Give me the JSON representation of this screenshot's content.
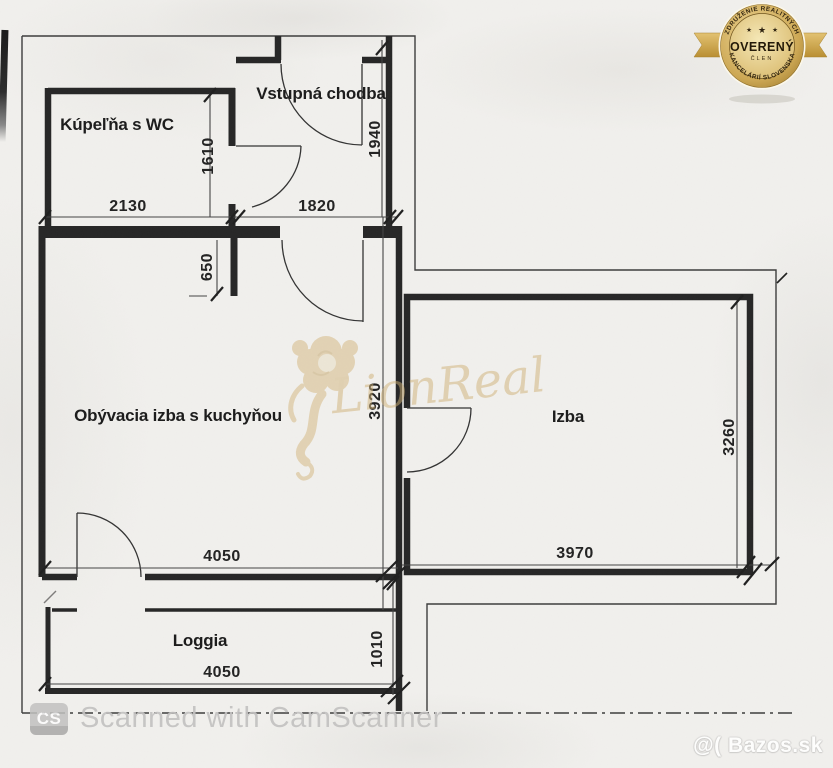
{
  "colors": {
    "paper": "#f1f0ed",
    "ink": "#2a2a2a",
    "watermark_gold": "#d2b278",
    "badge_gold": "#c9a449",
    "badge_text": "#2b1f0c",
    "scanner_gray": "#c3c2c1"
  },
  "plan": {
    "rooms": {
      "bathroom": "Kúpeľňa s WC",
      "hall": "Vstupná chodba",
      "living": "Obývacia izba s kuchyňou",
      "bedroom": "Izba",
      "loggia": "Loggia"
    },
    "dims": {
      "bathroom_width": "2130",
      "bathroom_depth": "1610",
      "hall_width": "1820",
      "hall_depth": "1940",
      "kitchen_wall": "650",
      "living_depth": "3920",
      "living_width": "4050",
      "bedroom_width": "3970",
      "bedroom_depth": "3260",
      "loggia_width": "4050",
      "loggia_depth": "1010"
    }
  },
  "badge": {
    "arc_top": "ZDRUŽENIE REALITNÝCH",
    "arc_bottom": "KANCELÁRIÍ SLOVENSKA",
    "title": "OVERENÝ",
    "subtitle": "ČLEN",
    "star": "★"
  },
  "watermark": {
    "brand": "LionReal"
  },
  "footer": {
    "cs_badge": "CS",
    "scanned_text": "Scanned with CamScanner",
    "bazos": "@( Bazos.sk"
  }
}
